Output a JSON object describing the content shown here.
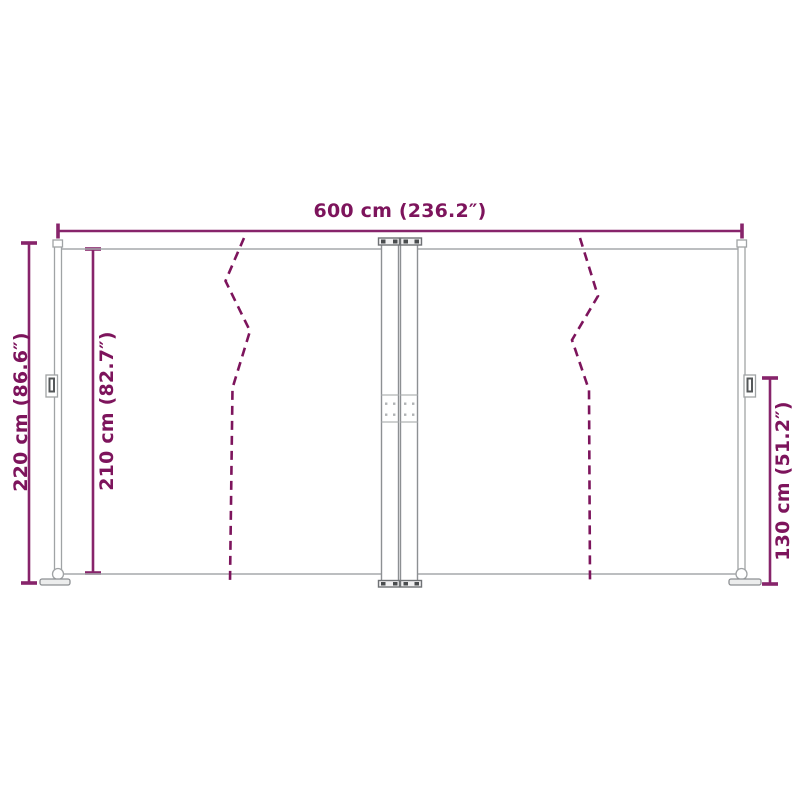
{
  "diagram": {
    "kind": "product-dimension-drawing",
    "labels": {
      "total_width": "600 cm (236.2″)",
      "total_height": "220 cm (86.6″)",
      "fabric_height": "210 cm (82.7″)",
      "right_section_height": "130 cm (51.2″)"
    },
    "colors": {
      "dimension_accent": "#7d145c",
      "structure_gray": "#a6a9ab",
      "structure_dark_gray": "#55585a",
      "background": "#ffffff"
    }
  }
}
